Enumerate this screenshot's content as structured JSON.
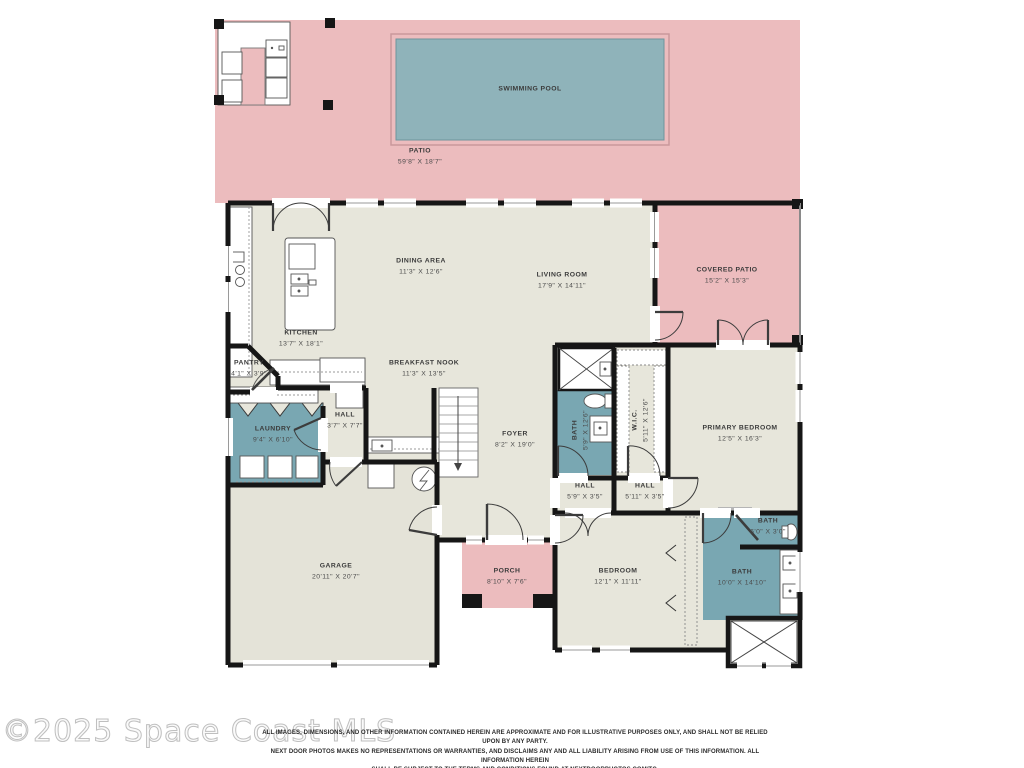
{
  "watermark": "©2025 Space Coast MLS",
  "disclaimer": {
    "line1": "ALL IMAGES, DIMENSIONS, AND OTHER INFORMATION CONTAINED HEREIN ARE APPROXIMATE AND FOR ILLUSTRATIVE PURPOSES ONLY, AND SHALL NOT BE RELIED UPON BY ANY PARTY.",
    "line2": "NEXT DOOR PHOTOS MAKES NO REPRESENTATIONS OR WARRANTIES, AND DISCLAIMS ANY AND ALL LIABILITY ARISING FROM USE OF THIS INFORMATION. ALL INFORMATION HEREIN",
    "line3": "SHALL BE SUBJECT TO THE TERMS AND CONDITIONS FOUND AT NEXTDOORPHOTOS.COM/TC."
  },
  "colors": {
    "patio_pink": "#ecbcbe",
    "pool_teal": "#8fb3ba",
    "room_beige": "#e7e6db",
    "wet_room_teal": "#79a7b2",
    "wall_black": "#161616"
  },
  "rooms": [
    {
      "name": "SWIMMING POOL",
      "dims": ""
    },
    {
      "name": "PATIO",
      "dims": "59'8\" X 18'7\""
    },
    {
      "name": "DINING AREA",
      "dims": "11'3\" X 12'6\""
    },
    {
      "name": "LIVING ROOM",
      "dims": "17'9\" X 14'11\""
    },
    {
      "name": "COVERED PATIO",
      "dims": "15'2\" X 15'3\""
    },
    {
      "name": "KITCHEN",
      "dims": "13'7\" X 18'1\""
    },
    {
      "name": "PANTRY",
      "dims": "4'1\" X 3'9\""
    },
    {
      "name": "BREAKFAST NOOK",
      "dims": "11'3\" X 13'5\""
    },
    {
      "name": "HALL",
      "dims": "3'7\" X 7'7\""
    },
    {
      "name": "LAUNDRY",
      "dims": "9'4\" X 6'10\""
    },
    {
      "name": "FOYER",
      "dims": "8'2\" X 19'0\""
    },
    {
      "name": "BATH",
      "dims": "5'9\" X 12'6\""
    },
    {
      "name": "W.I.C.",
      "dims": "5'11\" X 12'6\""
    },
    {
      "name": "PRIMARY BEDROOM",
      "dims": "12'5\" X 16'3\""
    },
    {
      "name": "HALL",
      "dims": "5'9\" X 3'5\""
    },
    {
      "name": "HALL",
      "dims": "5'11\" X 3'5\""
    },
    {
      "name": "GARAGE",
      "dims": "20'11\" X 20'7\""
    },
    {
      "name": "PORCH",
      "dims": "8'10\" X 7'6\""
    },
    {
      "name": "BEDROOM",
      "dims": "12'1\" X 11'11\""
    },
    {
      "name": "BATH",
      "dims": "6'0\" X 3'0\""
    },
    {
      "name": "BATH",
      "dims": "10'0\" X 14'10\""
    }
  ]
}
